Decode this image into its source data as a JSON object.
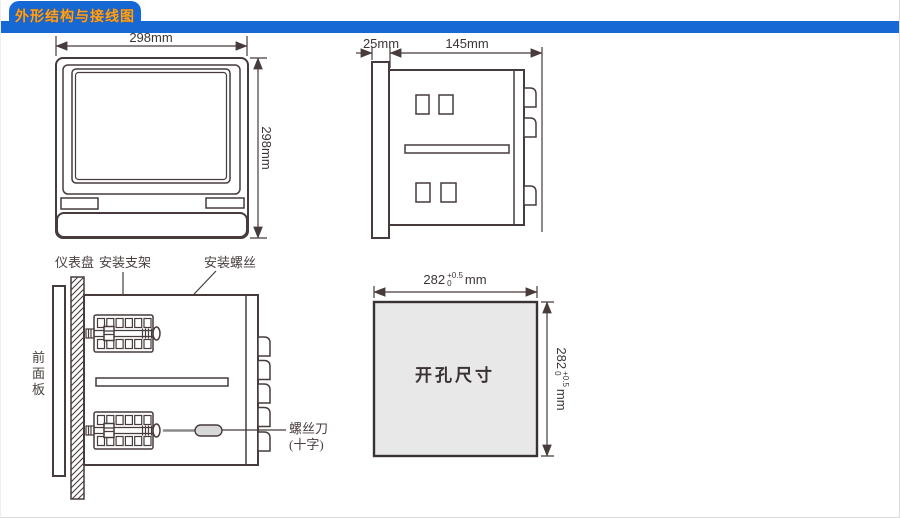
{
  "header": {
    "title": "外形结构与接线图",
    "bar_color": "#1668d4",
    "title_color": "#ffa01e"
  },
  "front_view": {
    "width_label": "298mm",
    "height_label": "298mm"
  },
  "side_view": {
    "flange_depth_label": "25mm",
    "body_depth_label": "145mm"
  },
  "install_view": {
    "label_panel_board": "仪表盘",
    "label_bracket": "安装支架",
    "label_screw": "安装螺丝",
    "label_front_panel": "前\n面\n板",
    "label_screwdriver_line1": "螺丝刀",
    "label_screwdriver_line2": "(十字)"
  },
  "cutout_view": {
    "center_label": "开孔尺寸",
    "dim_base": "282",
    "dim_tol_plus": "+0.5",
    "dim_tol_minus": "0",
    "dim_unit": "mm",
    "fill_color": "#e8e8e8"
  },
  "style": {
    "line_color": "#473b3b",
    "screwdriver_handle_color": "#d8d8d8"
  }
}
